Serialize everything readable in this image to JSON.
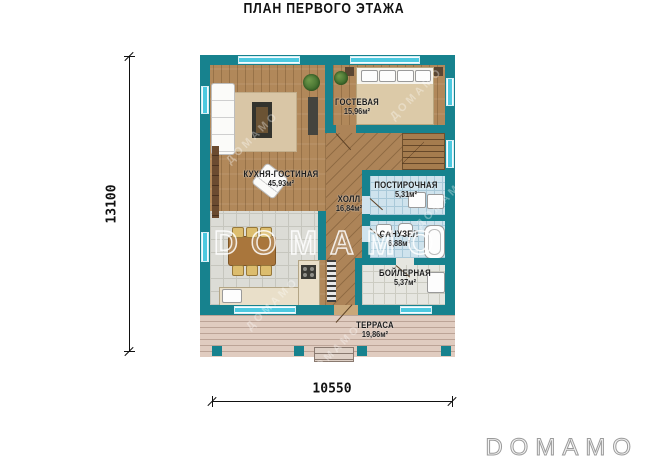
{
  "title": "ПЛАН ПЕРВОГО ЭТАЖА",
  "rooms": [
    {
      "name": "КУХНЯ-ГОСТИНАЯ",
      "area": "45,93м²"
    },
    {
      "name": "ГОСТЕВАЯ",
      "area": "15,96м²"
    },
    {
      "name": "ХОЛЛ",
      "area": "16,84м²"
    },
    {
      "name": "ПОСТИРОЧНАЯ",
      "area": "5,31м²"
    },
    {
      "name": "САНУЗЕЛ",
      "area": "6,88м²"
    },
    {
      "name": "БОЙЛЕРНАЯ",
      "area": "5,37м²"
    },
    {
      "name": "ТЕРРАСА",
      "area": "19,86м²"
    }
  ],
  "dimensions": {
    "vertical": "13100",
    "horizontal": "10550"
  },
  "watermark": {
    "center": "DOMAMO",
    "diagonal": "ДОМАМО",
    "logo": "DOMAMO"
  },
  "colors": {
    "wall": "#17828e",
    "window": "#4cc9e0",
    "wood": "#b1885a",
    "tile_kitchen": "#dcdcd6",
    "tile_wet": "#cfe3ed",
    "tile_light": "#e6e6e0",
    "terrace": "#e0ccc0",
    "label": "#1c1c1c"
  }
}
